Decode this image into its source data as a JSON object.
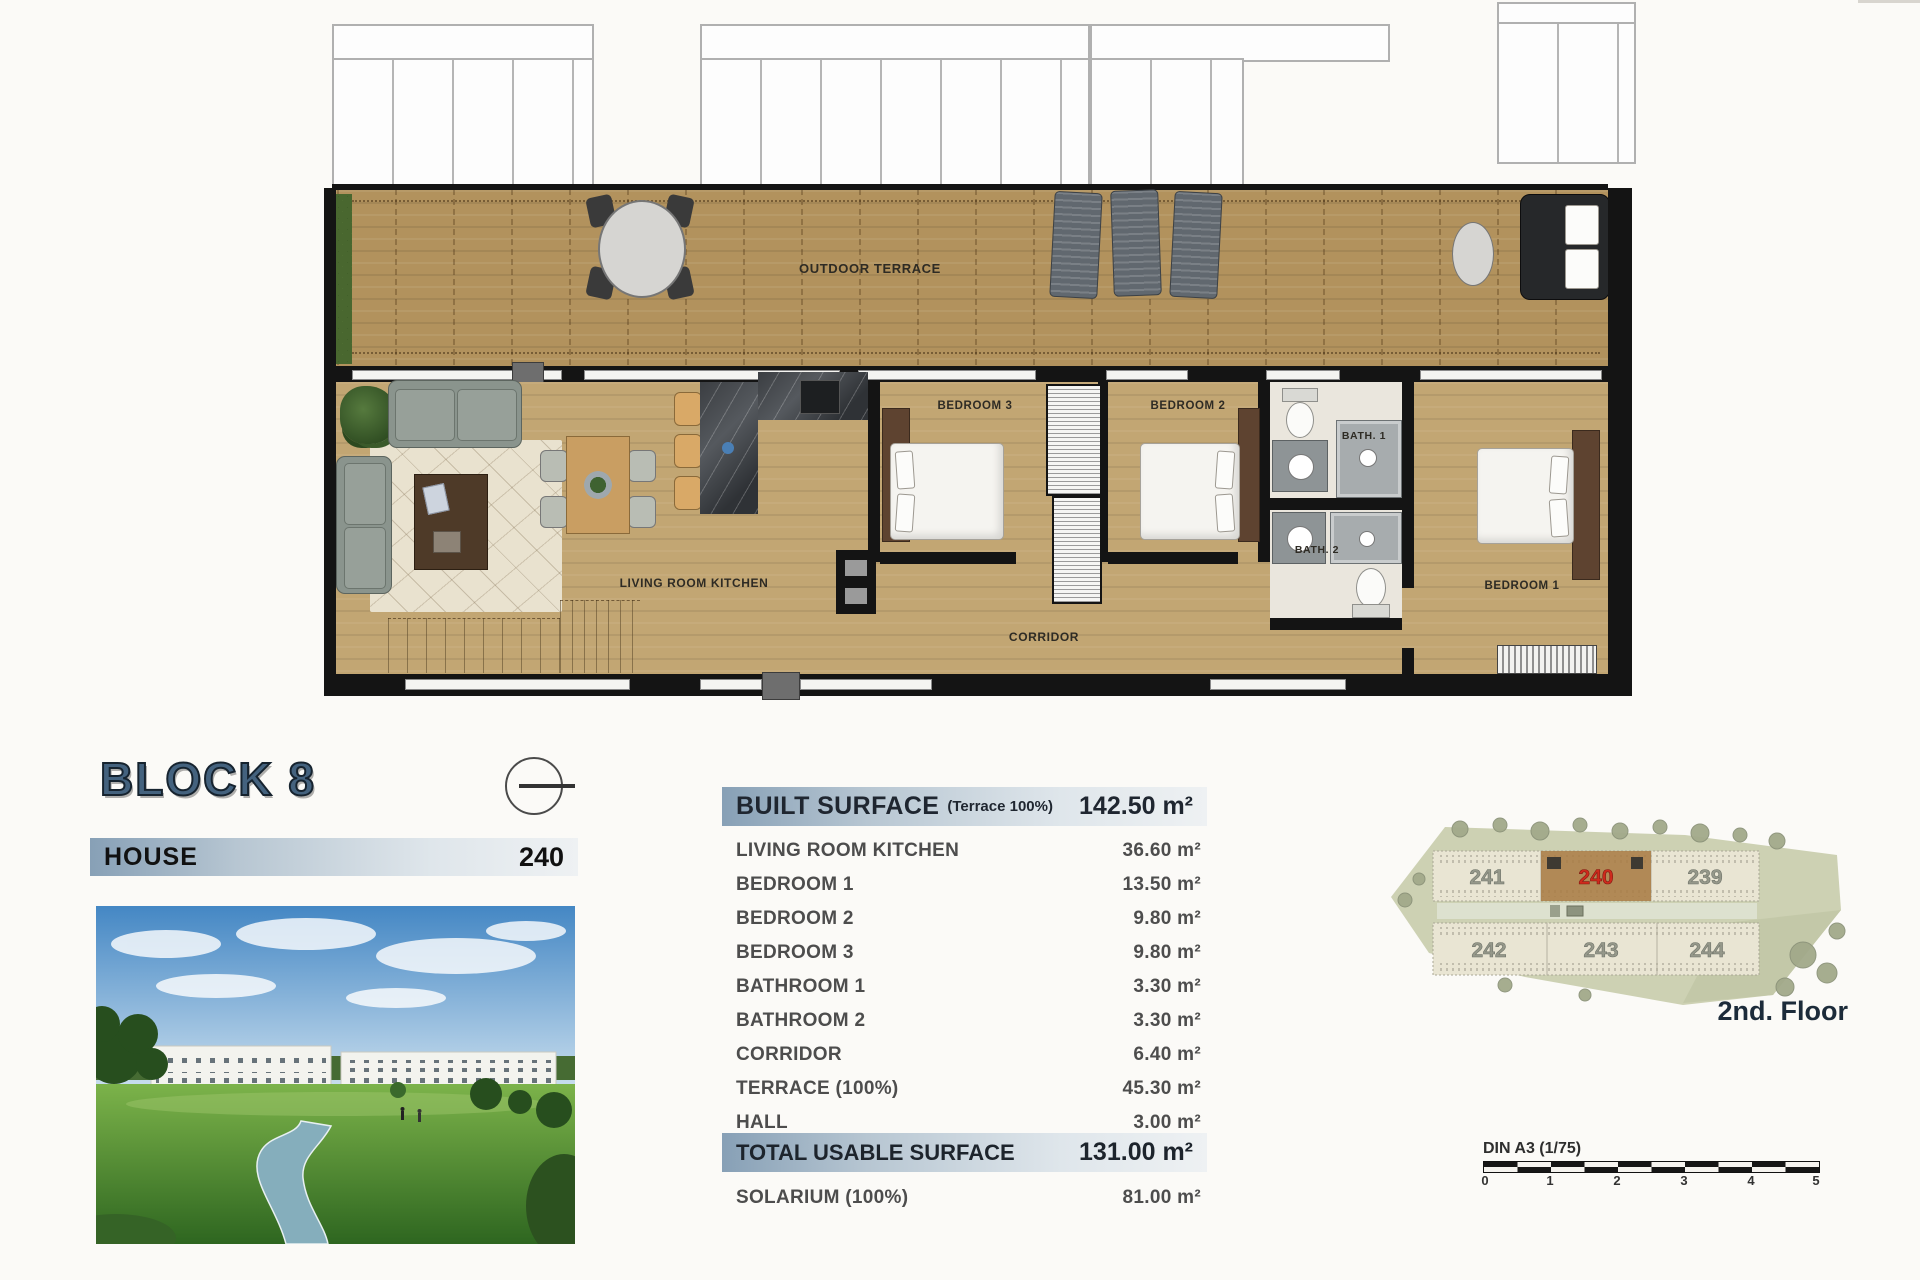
{
  "plan": {
    "labels": {
      "outdoor_terrace": "OUTDOOR TERRACE",
      "living_room_kitchen": "LIVING ROOM KITCHEN",
      "bedroom_1": "BEDROOM 1",
      "bedroom_2": "BEDROOM 2",
      "bedroom_3": "BEDROOM 3",
      "bath_1": "BATH. 1",
      "bath_2": "BATH. 2",
      "corridor": "CORRIDOR"
    }
  },
  "title_block": {
    "block": "BLOCK 8",
    "type_label": "HOUSE",
    "unit_number": "240"
  },
  "surface_table": {
    "header": {
      "label": "BUILT SURFACE",
      "note": "(Terrace 100%)",
      "value": "142.50 m²"
    },
    "rows": [
      {
        "label": "LIVING ROOM KITCHEN",
        "value": "36.60 m²"
      },
      {
        "label": "BEDROOM 1",
        "value": "13.50 m²"
      },
      {
        "label": "BEDROOM 2",
        "value": "9.80 m²"
      },
      {
        "label": "BEDROOM 3",
        "value": "9.80 m²"
      },
      {
        "label": "BATHROOM 1",
        "value": "3.30 m²"
      },
      {
        "label": "BATHROOM 2",
        "value": "3.30 m²"
      },
      {
        "label": "CORRIDOR",
        "value": "6.40 m²"
      },
      {
        "label": "TERRACE (100%)",
        "value": "45.30 m²"
      },
      {
        "label": "HALL",
        "value": "3.00 m²"
      }
    ],
    "total": {
      "label": "TOTAL USABLE SURFACE",
      "value": "131.00 m²"
    },
    "solarium": {
      "label": "SOLARIUM (100%)",
      "value": "81.00 m²"
    }
  },
  "site_plan": {
    "floor_label": "2nd. Floor",
    "top_units": [
      "241",
      "240",
      "239"
    ],
    "bottom_units": [
      "242",
      "243",
      "244"
    ],
    "highlighted_unit": "240"
  },
  "scale_bar": {
    "label": "DIN A3 (1/75)",
    "ticks": [
      "0",
      "1",
      "2",
      "3",
      "4",
      "5"
    ]
  },
  "colors": {
    "header_gradient_start": "#87a0b6",
    "block_title": "#44627e",
    "highlight_red": "#cf2a1c",
    "terrace_wood": "#b2925d",
    "interior_wood": "#c2a673"
  }
}
